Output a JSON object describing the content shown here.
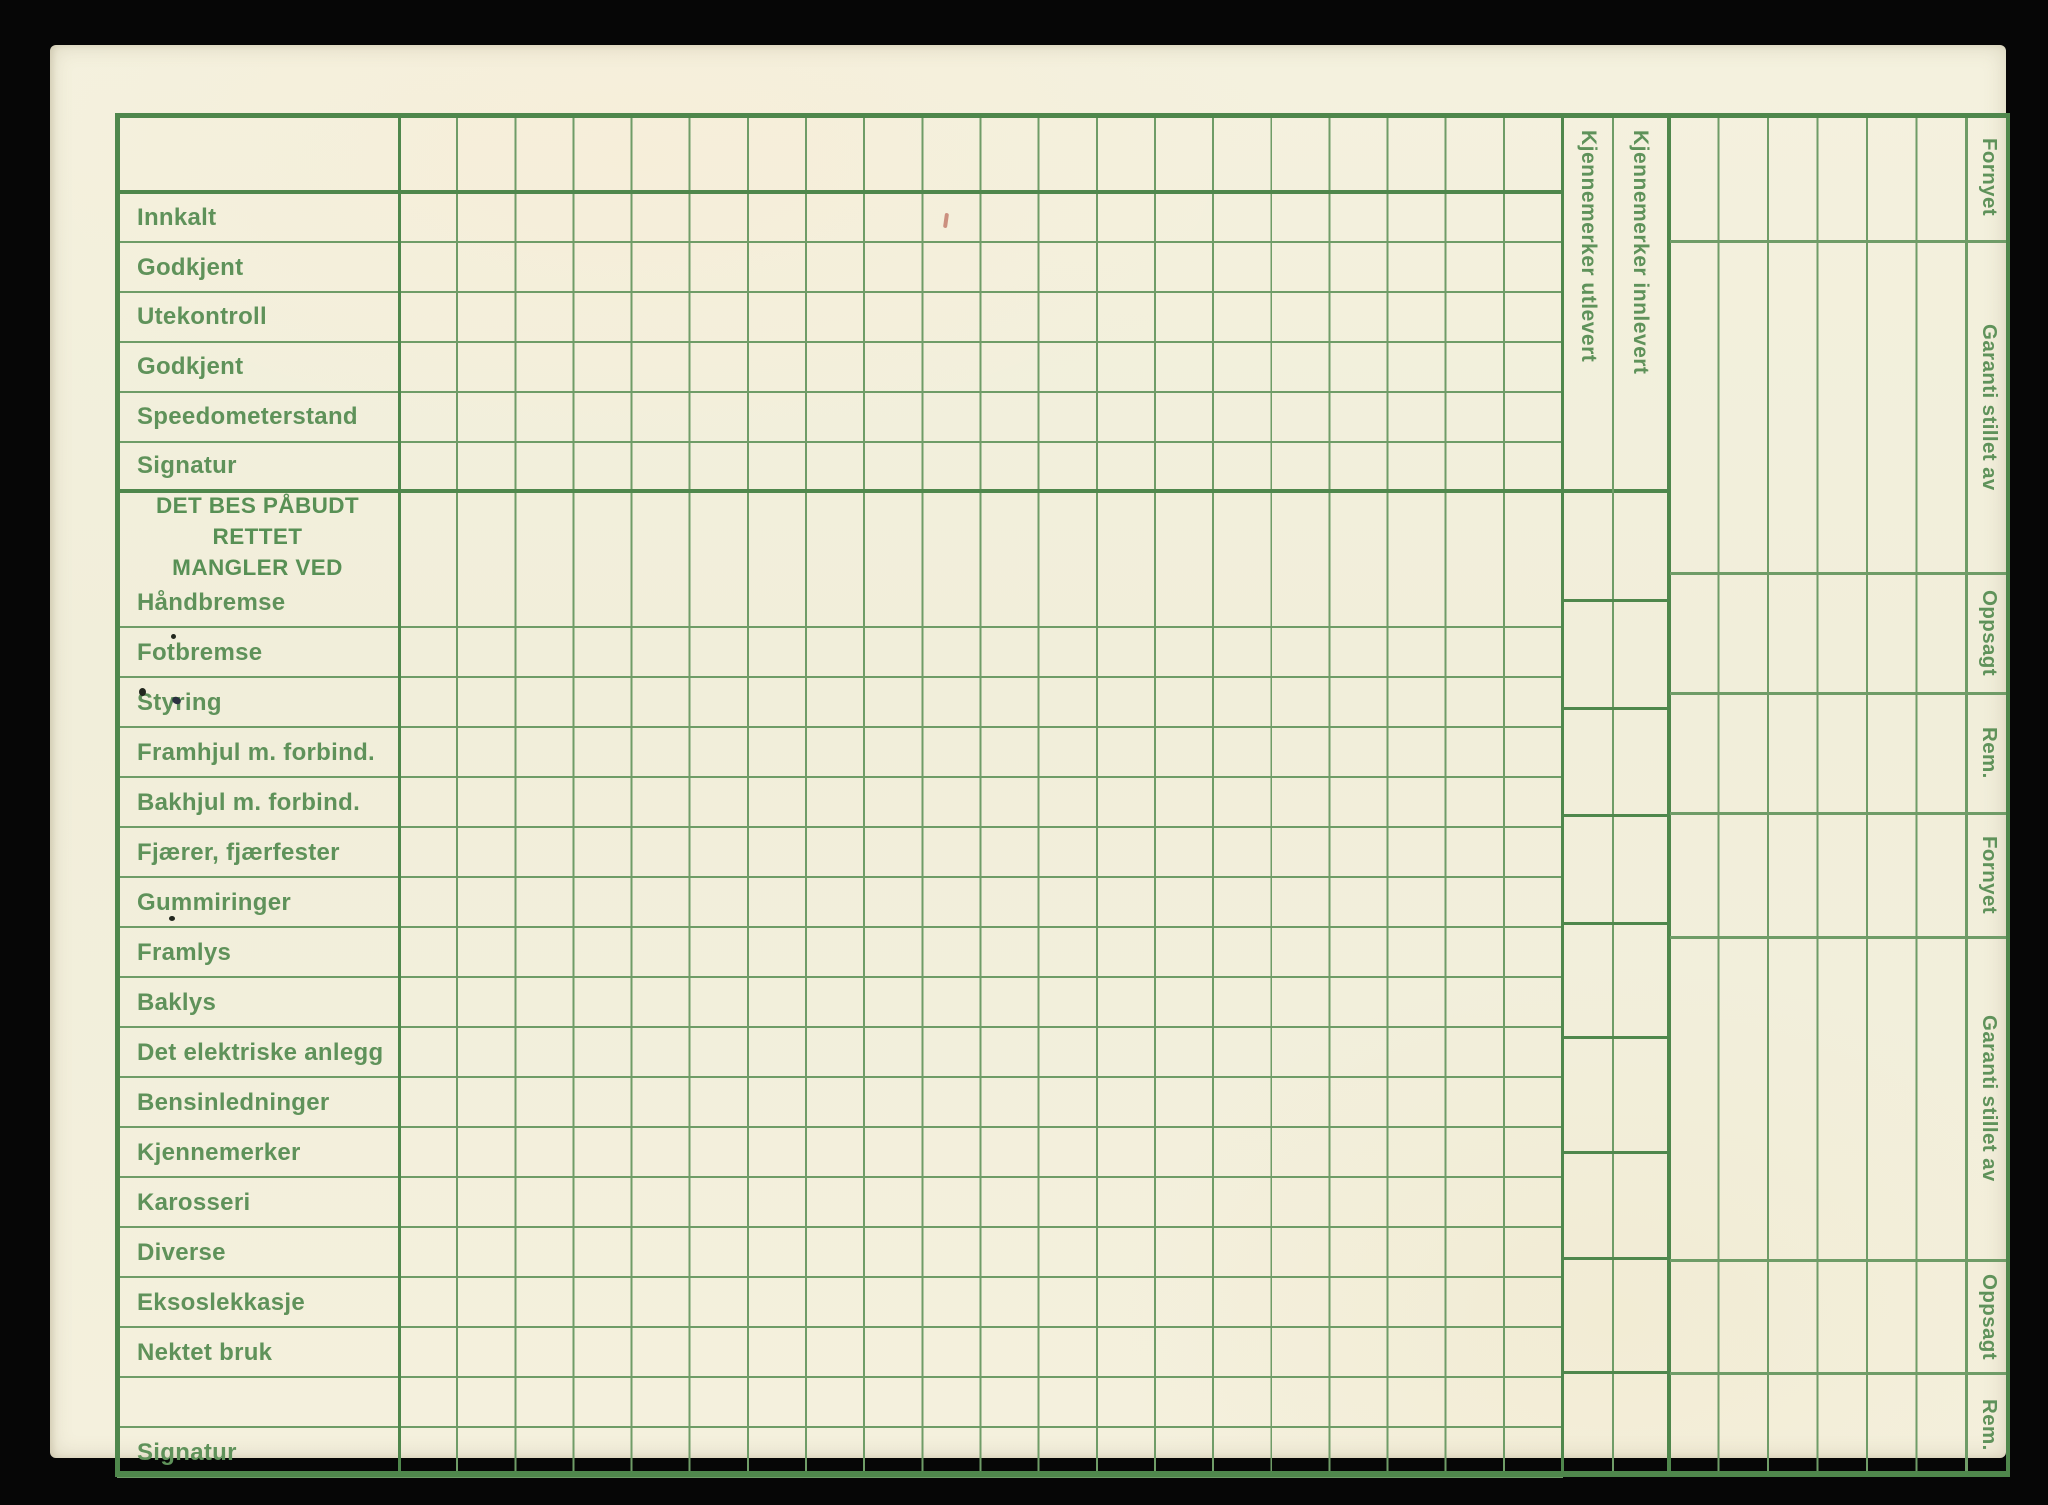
{
  "card": {
    "top_rows": [
      "Innkalt",
      "Godkjent",
      "Utekontroll",
      "Godkjent",
      "Speedometerstand",
      "Signatur"
    ],
    "defects_header_line1": "DET BES PÅBUDT RETTET",
    "defects_header_line2": "MANGLER VED",
    "defect_rows": [
      "Håndbremse",
      "Fotbremse",
      "Styring",
      "Framhjul m. forbind.",
      "Bakhjul m. forbind.",
      "Fjærer, fjærfester",
      "Gummiringer",
      "Framlys",
      "Baklys",
      "Det elektriske anlegg",
      "Bensinledninger",
      "Kjennemerker",
      "Karosseri",
      "Diverse",
      "Eksoslekkasje",
      "Nektet bruk"
    ],
    "bottom_rows": [
      "",
      "Signatur"
    ],
    "plate_columns": [
      "Kjennemerker utlevert",
      "Kjennemerker innlevert"
    ],
    "right_sections": [
      "Fornyet",
      "Garanti stillet av",
      "Oppsagt",
      "Rem.",
      "Fornyet",
      "Garanti stillet av",
      "Oppsagt",
      "Rem."
    ],
    "colors": {
      "paper": "#f3f0dd",
      "ink": "#5f925a",
      "ink_dark": "#589055",
      "line": "#6f9c67",
      "line_heavy": "#4f874c",
      "background": "#060606"
    }
  }
}
